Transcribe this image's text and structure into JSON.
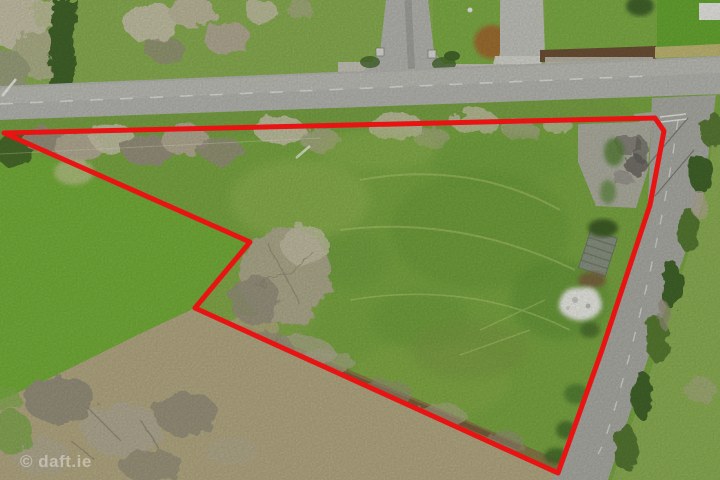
{
  "watermark": {
    "text": "© daft.ie",
    "color": "#ffffff",
    "opacity": 0.38
  },
  "boundary": {
    "points": "4,133 655,118 664,131 650,205 602,350 558,473 195,308 250,242",
    "color": "#e81414",
    "stroke_width": 5
  },
  "palette": {
    "red": "#e81414",
    "road": "#b6b7b1",
    "road_light": "#c4c4be",
    "side_road": "#abaca4",
    "lawn": "#8aaf52",
    "lawn_vivid": "#68a832",
    "lawn_right": "#7fae46",
    "parcel": "#7ba843",
    "parcel_light": "#9ab958",
    "parcel_dark": "#699a38",
    "field_left": "#76b03a",
    "field_right": "#8db054",
    "verge": "#7aa246",
    "hedge_dark": "#43652a",
    "scrub": "#b3ab93",
    "scrub_dark": "#97917c",
    "scrub_pale": "#c6c2a8",
    "dead_grass": "#b5aa84",
    "dirt": "#8d6a49",
    "wall": "#c7c4b8",
    "shed": "#8a9383",
    "shed_dark": "#6e7a63",
    "debris": "#ebebe5",
    "copper": "#a06f33",
    "soil": "#6e5136",
    "curb": "#c0b975"
  }
}
